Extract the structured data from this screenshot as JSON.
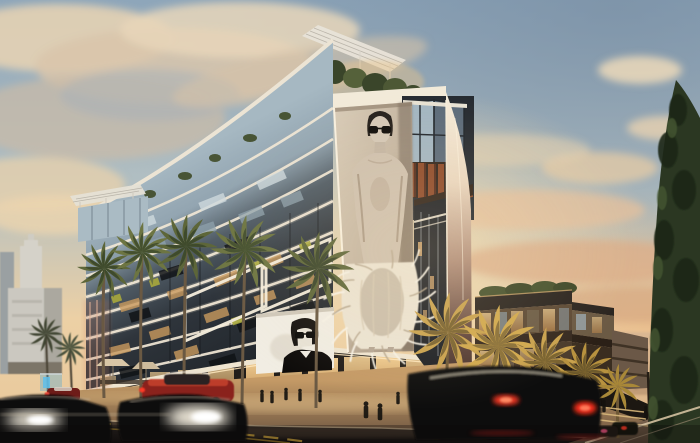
{
  "scene": {
    "type": "architectural rendering",
    "time_of_day": "sunset dusk",
    "description": "Street-corner view of a modern mixed-use building at dusk with a giant black-and-white fashion billboard on its corner, lit floor bands, palm-lined sidewalk, glowing storefronts, motion-blurred traffic and a tall cypress tree at right",
    "main_building": {
      "label": "main-building",
      "features": [
        "rooftop trellis and garden",
        "illuminated white floor bands",
        "glass upper floors",
        "dark window grid",
        "chartreuse accent panels",
        "glass penthouse box",
        "rust-orange fins",
        "white curved corner",
        "lit ground-floor retail"
      ]
    },
    "billboard_large": {
      "label": "fashion-model-billboard",
      "style": "black-and-white photograph on beige panel",
      "subject": "model with slicked hair, dark sunglasses, bare shoulders and feathered dress"
    },
    "billboard_small": {
      "label": "portrait-billboard",
      "style": "black-and-white graphic on white panel",
      "subject": "figure with dark hair, large sunglasses and black high-collar outfit"
    },
    "annex_building": {
      "label": "terraced-annex",
      "features": [
        "stepped terraces",
        "roof planting",
        "warm lit glazing"
      ]
    },
    "background": {
      "left_building": "white art-deco tower",
      "right": "hazy distant city skyline",
      "tree": "tall dark cypress"
    },
    "street": {
      "elements": [
        "sidewalk cafe umbrellas",
        "bus shelter with blue glow",
        "double yellow center line",
        "side street sloping right",
        "utility pole"
      ],
      "pedestrian_count": 15,
      "palm_trees_green": 6,
      "palm_trees_golden": 5,
      "cars": [
        "blurred dark suv foreground",
        "blurred dark car with headlight glare",
        "red coupe",
        "small red car",
        "dark sedan with red taillights",
        "distant cars"
      ]
    }
  },
  "palette": {
    "sky_top": "#8ea6ba",
    "sky_steel": "#7b92a8",
    "sky_gold": "#ecd0a5",
    "sunset_glow": "#f6ddb0",
    "cloud_cream": "#e8d5b7",
    "cloud_shadow": "#a9b2b8",
    "facade_light_glass": "#a6b8c2",
    "facade_dark": "#20242a",
    "band_white": "#f2e8d6",
    "window_warm": "#cf9f63",
    "accent_chartreuse": "#a9a93c",
    "rust_fin": "#8e4a2a",
    "corner_white": "#f3e9d8",
    "billboard_bg_light": "#d9ccb8",
    "billboard_bg_dark": "#a08f7c",
    "model_skin": "#d5c8b7",
    "feather_cream": "#ece4d3",
    "small_billboard_bg": "#f1ede3",
    "storefront_glow": "#f0cd92",
    "sidewalk_warm": "#c49a66",
    "road_dark": "#161310",
    "taillight_red": "#ff3a26",
    "headlight_white": "#fff8e8",
    "palm_green": "#5d6639",
    "palm_gold": "#c9a24e",
    "cypress_green": "#2b3722",
    "annex_warm": "#c89b63",
    "distant_haze": "#d9b794",
    "deco_building": "#cbc8c0"
  }
}
